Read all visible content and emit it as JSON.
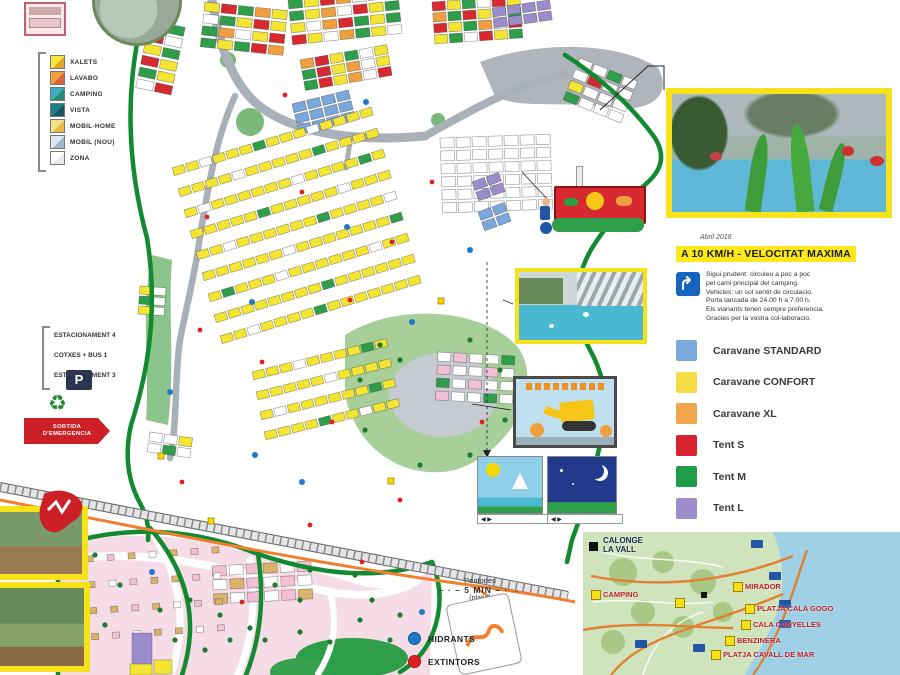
{
  "left_legend": {
    "items": [
      {
        "label": "XALETS",
        "color": "#f5e83a",
        "color2": "#e0a92c"
      },
      {
        "label": "LAVABO",
        "color": "#f0a03c",
        "color2": "#d9663a"
      },
      {
        "label": "CAMPING",
        "color": "#3aaec0",
        "color2": "#2a8a6a"
      },
      {
        "label": "VISTA",
        "color": "#1d7f8c",
        "color2": "#14555e"
      },
      {
        "label": "MOBIL-HOME",
        "color": "#f5df8a",
        "color2": "#e8b84a"
      },
      {
        "label": "MOBIL (NOU)",
        "color": "#dce8f2",
        "color2": "#9fb8cc"
      },
      {
        "label": "ZONA",
        "color": "#ffffff",
        "color2": "#e8e8e8"
      }
    ]
  },
  "parking_list": {
    "lines": [
      "ESTACIONAMENT 4",
      "COTXES + BUS 1",
      "ESTACIONAMENT 3"
    ]
  },
  "emergency_sign": {
    "line1": "SORTIDA",
    "line2": "D'EMERGENCIA"
  },
  "icons": {
    "parking": "P",
    "recycle": "♻",
    "arrows": "◀ ▶"
  },
  "right_panel": {
    "date_note": "Abril 2018",
    "headline": "A 10 KM/H - VELOCITAT MAXIMA",
    "info_lines": [
      "Sigui prudent: circuleu a poc a poc",
      "pel cami principal del camping.",
      "Vehicles: un sol sentit de circulacio.",
      "Porta tancada de 24.00 h a 7.00 h.",
      "Els vianants tenen sempre preferencia.",
      "Gracies per la vostra col-laboracio."
    ],
    "legend": [
      {
        "label": "Caravane STANDARD",
        "color": "#7aa7dc"
      },
      {
        "label": "Caravane CONFORT",
        "color": "#f5dc45"
      },
      {
        "label": "Caravane XL",
        "color": "#f0a54a"
      },
      {
        "label": "Tent S",
        "color": "#d8232f"
      },
      {
        "label": "Tent M",
        "color": "#1f9d4b"
      },
      {
        "label": "Tent L",
        "color": "#9b8ccc"
      }
    ]
  },
  "bottom_legend": {
    "hydrants": "HIDRANTS",
    "extinguishers": "EXTINTORS",
    "hydrant_color": "#1f78c8",
    "extinguisher_color": "#e02020"
  },
  "footpath": {
    "top": "Peatones",
    "mid": "5 MIN",
    "bottom": "(platja)"
  },
  "inset_map": {
    "town_line1": "CALONGE",
    "town_line2": "LA VALL",
    "labels": [
      "CAMPING",
      "MIRADOR",
      "PLATJA CALA GOGO",
      "CALA CANYELLES",
      "BENZINERA",
      "PLATJA CAVALL DE MAR"
    ]
  },
  "map": {
    "colors": {
      "Y": "#f3e532",
      "G": "#2f9e4a",
      "R": "#d62a30",
      "O": "#f09f3e",
      "B": "#7aa7dc",
      "P": "#9b8ccc",
      "W": "#ffffff",
      "K": "#f2bfd4",
      "T": "#d9b36a"
    },
    "clusters": [
      {
        "x": 150,
        "y": 20,
        "cols": 2,
        "rows": 6,
        "w": 17,
        "h": 9,
        "gx": 2,
        "gy": 3,
        "a": 12,
        "p": "YGRWYGRYGYWR"
      },
      {
        "x": 205,
        "y": 2,
        "cols": 5,
        "rows": 4,
        "w": 15,
        "h": 9,
        "gx": 2,
        "gy": 3,
        "a": 6,
        "p": "YRGOYWGYRYGOWYRGYGRO"
      },
      {
        "x": 288,
        "y": 0,
        "cols": 7,
        "rows": 4,
        "w": 14,
        "h": 9,
        "gx": 2,
        "gy": 3,
        "a": -6,
        "p": "GYROWYRGYOWRYGYWORGYGRYWOGYW"
      },
      {
        "x": 300,
        "y": 60,
        "cols": 6,
        "rows": 3,
        "w": 13,
        "h": 9,
        "gx": 2,
        "gy": 2,
        "a": -10,
        "p": "ORYGWYGRYOWYGRYOWR"
      },
      {
        "x": 292,
        "y": 104,
        "cols": 4,
        "rows": 3,
        "w": 13,
        "h": 9,
        "gx": 2,
        "gy": 2,
        "a": -14,
        "p": "BBBBBBBBBBBB"
      },
      {
        "x": 432,
        "y": 2,
        "cols": 6,
        "rows": 4,
        "w": 13,
        "h": 9,
        "gx": 2,
        "gy": 2,
        "a": -4,
        "p": "RYGWRYOGRYWGRYGOWRYGWRYG"
      },
      {
        "x": 492,
        "y": 8,
        "cols": 4,
        "rows": 2,
        "w": 13,
        "h": 9,
        "gx": 2,
        "gy": 2,
        "a": -8,
        "p": "PPPPPPPP"
      },
      {
        "x": 440,
        "y": 138,
        "cols": 7,
        "rows": 6,
        "w": 14,
        "h": 10,
        "gx": 2,
        "gy": 3,
        "a": -2,
        "p": "W"
      },
      {
        "x": 472,
        "y": 182,
        "cols": 2,
        "rows": 2,
        "w": 13,
        "h": 9,
        "gx": 2,
        "gy": 2,
        "a": -20,
        "p": "P"
      },
      {
        "x": 478,
        "y": 212,
        "cols": 2,
        "rows": 2,
        "w": 13,
        "h": 9,
        "gx": 2,
        "gy": 2,
        "a": -20,
        "p": "B"
      },
      {
        "x": 580,
        "y": 58,
        "cols": 4,
        "rows": 4,
        "w": 14,
        "h": 9,
        "gx": 2,
        "gy": 3,
        "a": 22,
        "p": "WWGWWRWWYWWWGWWW"
      },
      {
        "x": 172,
        "y": 168,
        "cols": 15,
        "rows": 1,
        "w": 12,
        "h": 8,
        "gx": 2,
        "gy": 0,
        "a": -17,
        "p": "YYWYYYGYYYWYYYY"
      },
      {
        "x": 178,
        "y": 189,
        "cols": 15,
        "rows": 1,
        "w": 12,
        "h": 8,
        "gx": 2,
        "gy": 0,
        "a": -17,
        "p": "YYYYWYYYYYGYYYY"
      },
      {
        "x": 184,
        "y": 210,
        "cols": 15,
        "rows": 1,
        "w": 12,
        "h": 8,
        "gx": 2,
        "gy": 0,
        "a": -17,
        "p": "YWYYYYYYWYYYYGY"
      },
      {
        "x": 190,
        "y": 231,
        "cols": 15,
        "rows": 1,
        "w": 12,
        "h": 8,
        "gx": 2,
        "gy": 0,
        "a": -17,
        "p": "YYYYYGYYYYYWYYY"
      },
      {
        "x": 196,
        "y": 252,
        "cols": 15,
        "rows": 1,
        "w": 12,
        "h": 8,
        "gx": 2,
        "gy": 0,
        "a": -17,
        "p": "YYWYYYYYYGYYYYW"
      },
      {
        "x": 202,
        "y": 273,
        "cols": 15,
        "rows": 1,
        "w": 12,
        "h": 8,
        "gx": 2,
        "gy": 0,
        "a": -17,
        "p": "YYYYYYWYYYYYYYG"
      },
      {
        "x": 208,
        "y": 294,
        "cols": 15,
        "rows": 1,
        "w": 12,
        "h": 8,
        "gx": 2,
        "gy": 0,
        "a": -17,
        "p": "YGYYYWYYYYYYWYY"
      },
      {
        "x": 214,
        "y": 315,
        "cols": 15,
        "rows": 1,
        "w": 12,
        "h": 8,
        "gx": 2,
        "gy": 0,
        "a": -17,
        "p": "YYYYYYYYGYYYYYY"
      },
      {
        "x": 220,
        "y": 336,
        "cols": 15,
        "rows": 1,
        "w": 12,
        "h": 8,
        "gx": 2,
        "gy": 0,
        "a": -17,
        "p": "YYWYYYYGYYYYYYY"
      },
      {
        "x": 252,
        "y": 372,
        "cols": 10,
        "rows": 1,
        "w": 12,
        "h": 8,
        "gx": 2,
        "gy": 0,
        "a": -14,
        "p": "YYYWYYYYGY"
      },
      {
        "x": 256,
        "y": 392,
        "cols": 10,
        "rows": 1,
        "w": 12,
        "h": 8,
        "gx": 2,
        "gy": 0,
        "a": -14,
        "p": "YYYYYWYYYY"
      },
      {
        "x": 260,
        "y": 412,
        "cols": 10,
        "rows": 1,
        "w": 12,
        "h": 8,
        "gx": 2,
        "gy": 0,
        "a": -14,
        "p": "YWYYYYYYGY"
      },
      {
        "x": 264,
        "y": 432,
        "cols": 10,
        "rows": 1,
        "w": 12,
        "h": 8,
        "gx": 2,
        "gy": 0,
        "a": -14,
        "p": "YYYYGYYWYY"
      },
      {
        "x": 438,
        "y": 352,
        "cols": 5,
        "rows": 4,
        "w": 13,
        "h": 9,
        "gx": 3,
        "gy": 4,
        "a": 3,
        "p": "WKWWGKWWKWGWKWWKWWGW"
      },
      {
        "x": 212,
        "y": 566,
        "cols": 6,
        "rows": 3,
        "w": 14,
        "h": 10,
        "gx": 3,
        "gy": 4,
        "a": -3,
        "p": "KWKTWKWTKWKWTWKWKT"
      },
      {
        "x": 150,
        "y": 432,
        "cols": 3,
        "rows": 2,
        "w": 13,
        "h": 9,
        "gx": 2,
        "gy": 2,
        "a": 8,
        "p": "WWYWGW"
      },
      {
        "x": 140,
        "y": 286,
        "cols": 2,
        "rows": 3,
        "w": 12,
        "h": 8,
        "gx": 2,
        "gy": 2,
        "a": 4,
        "p": "YWGWYW"
      },
      {
        "x": 86,
        "y": 556,
        "cols": 7,
        "rows": 4,
        "w": 7,
        "h": 6,
        "gx": 14,
        "gy": 20,
        "a": -4,
        "p": "TKTWTKTTWKTTKWTTKTWKTTKWTTWK"
      }
    ]
  }
}
